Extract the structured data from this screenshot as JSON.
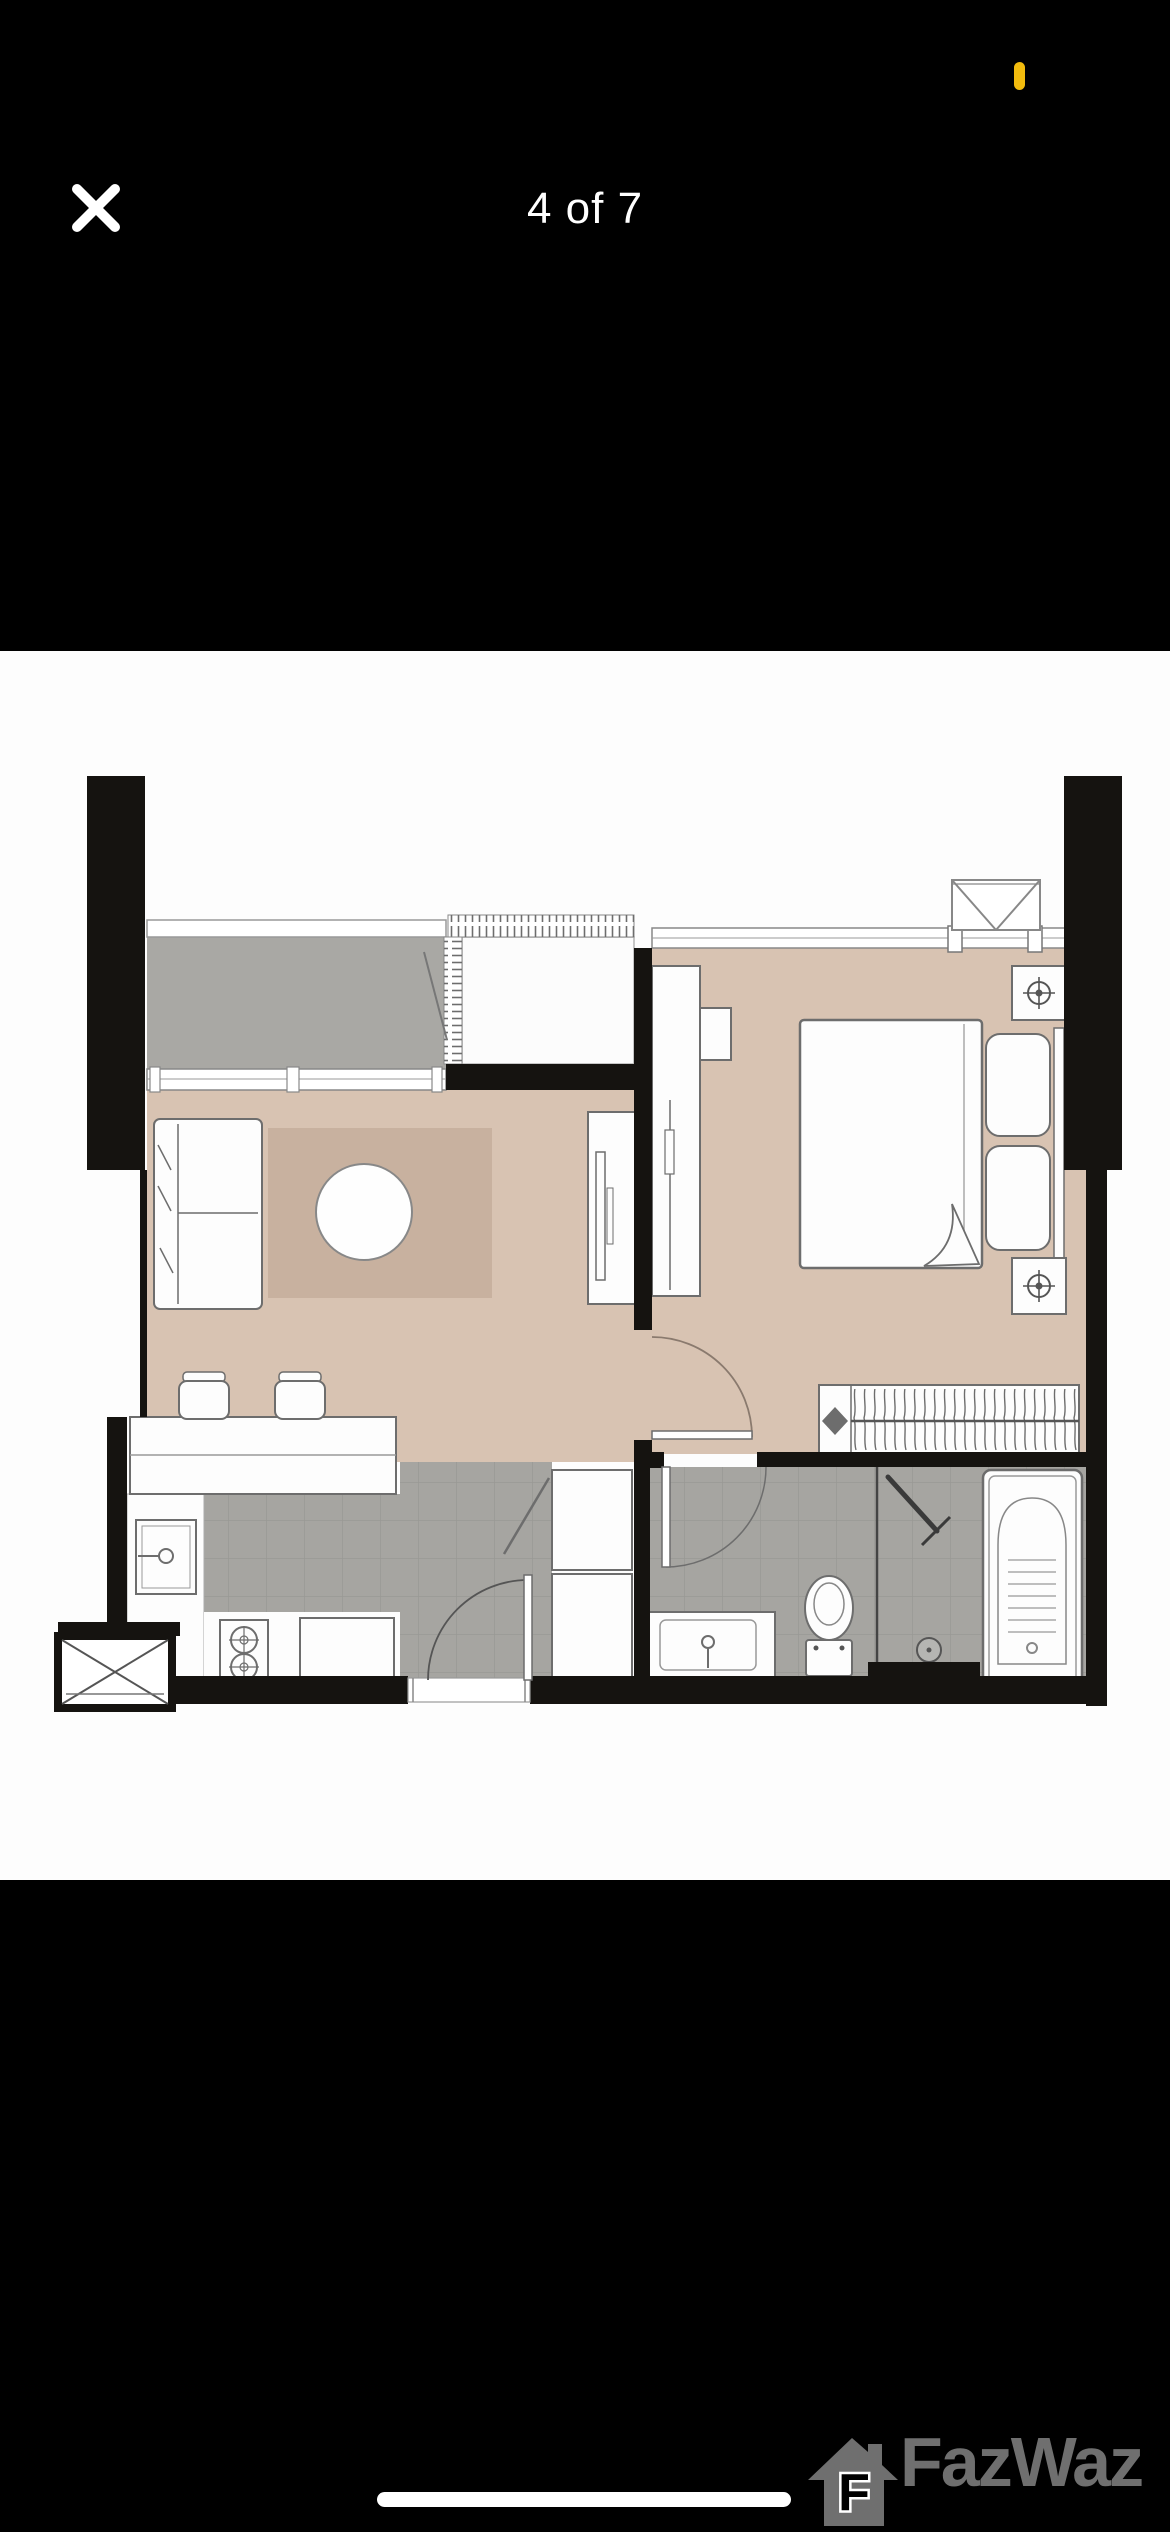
{
  "screen": {
    "width": 1170,
    "height": 2532
  },
  "status_bar": {
    "recording_indicator": "yellow-pill"
  },
  "viewer": {
    "counter": "4 of 7",
    "close_icon": "x",
    "image": {
      "type": "floor-plan",
      "description": "One-bedroom condominium unit floor plan",
      "rooms": [
        "balcony",
        "living-dining",
        "bedroom",
        "kitchen",
        "bathroom",
        "elevator-shaft"
      ]
    }
  },
  "watermark": {
    "brand": "FazWaz",
    "icon_letter": "F"
  },
  "colors": {
    "bg": "#000000",
    "accent": "#f2bb0d",
    "watermark": "#6f6f6f",
    "plan-white": "#fdfdfd",
    "tan": "#d8c3b2",
    "rug": "#c8b19f",
    "balcony": "#a9a8a4",
    "tile": "#a6a5a1",
    "wall": "#151310"
  }
}
